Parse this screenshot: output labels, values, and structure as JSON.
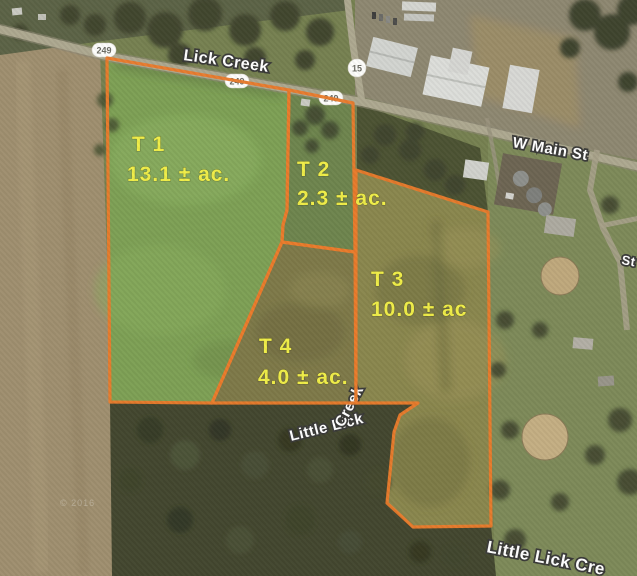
{
  "map": {
    "road_labels": {
      "lick_creek": "Lick Creek",
      "w_main_st": "W Main St",
      "st_partial": "St"
    },
    "creek_label_mid": {
      "part1": "Little Lick",
      "part2": "Creek"
    },
    "creek_label_bottom": "Little Lick Cre",
    "route_shields": [
      {
        "type": "oval",
        "text": "249"
      },
      {
        "type": "oval",
        "text": "249"
      },
      {
        "type": "oval",
        "text": "249"
      },
      {
        "type": "circle",
        "text": "15"
      }
    ],
    "tracts": [
      {
        "id": "T1",
        "name": "T 1",
        "acreage": "13.1 ± ac."
      },
      {
        "id": "T2",
        "name": "T 2",
        "acreage": "2.3 ± ac."
      },
      {
        "id": "T3",
        "name": "T 3",
        "acreage": "10.0 ± ac"
      },
      {
        "id": "T4",
        "name": "T 4",
        "acreage": "4.0 ± ac."
      }
    ],
    "watermark": "© 2016",
    "colors": {
      "parcel_line": "#e97b2b",
      "tract_label": "#f0ee48",
      "road_label": "#ffffff"
    }
  }
}
